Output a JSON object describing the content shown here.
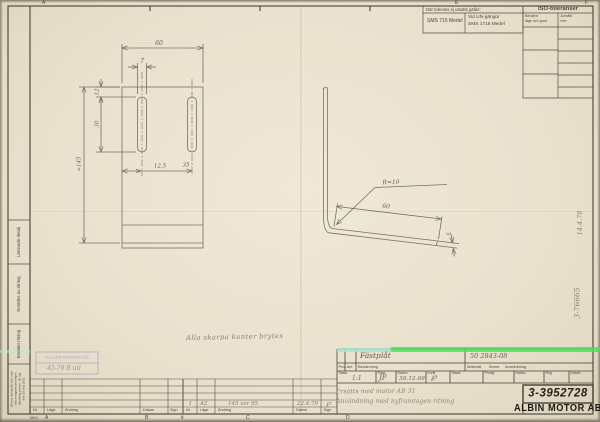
{
  "edge": {
    "top": {
      "a": "A",
      "e": "E",
      "f": "F"
    },
    "bottom": {
      "mko": "MKO",
      "a": "A",
      "b": "B",
      "v": "∨",
      "c": "C",
      "d": "D"
    }
  },
  "tol_table": {
    "header": "Där tolerans ej utsatts gäller:",
    "medel": "SMS 715 Medel",
    "un1": "Vid UN-gängor",
    "un2": "SMS 1718 Medel"
  },
  "iso_table": {
    "title": "ISO-toleranser",
    "col1_line1": "Benämn",
    "col1_line2": "läge och grad",
    "col2_line1": "Avmått",
    "col2_line2": "mm"
  },
  "left_margin": {
    "box1": "Lämnade detalj",
    "box2": "Ersättes av ritning",
    "box3": "Ersätter ritning",
    "legal1": "Denna ritning får icke utan",
    "legal2": "vårt medgivande delges",
    "legal3": "obehörig person. Jfr lag",
    "legal4": "den 29 maj 1931"
  },
  "stamp": {
    "line1": "TILLHÖR AKRONOLÖJD",
    "line2": "45-79 B utl"
  },
  "drawing": {
    "note": "Alla skarpa kanter brytes",
    "left_view": {
      "width": "60",
      "slot_width": "7",
      "edge_offset": "12",
      "slot_length": "30",
      "height": "≈145",
      "pos1": "12,5",
      "pos2": "35"
    },
    "right_view": {
      "radius": "R≈10",
      "leg": "60",
      "thickness": "3"
    },
    "margin_date": "14.4.78",
    "margin_ref": "3-76665"
  },
  "title_block": {
    "name_value": "Fästplåt",
    "material_value": "50 2843-08",
    "pos": "Pos",
    "ant": "Ant",
    "benamning": "Benämning",
    "material": "Material",
    "amne": "Ämne",
    "anmarkning": "Anmärkning",
    "skala": "Skala",
    "skala_value": "1:1",
    "ritad": "Ritad",
    "ritad_value": "JP",
    "datum1": "Datum",
    "datum1_value": "30.12.69",
    "kontr": "Kontr",
    "kontr_value": "℘",
    "stand": "Stand",
    "prodgr": "Prodgr",
    "datum2": "Datum",
    "reg": "Reg",
    "datum3": "Datum",
    "note1": "Ersätts med motor AB 31",
    "note2": "Användning med nyframtagen ritning",
    "number": "3-3952728",
    "company": "ALBIN MOTOR AB"
  },
  "rev_table": {
    "nr": "Nr",
    "lage": "Läge",
    "andring": "Ändring",
    "datum": "Datum",
    "sign": "Sign",
    "entry": {
      "nr": "1",
      "lage": "A2",
      "andring": "145 var 95",
      "datum": "22.4.70",
      "sign": "℘"
    }
  }
}
